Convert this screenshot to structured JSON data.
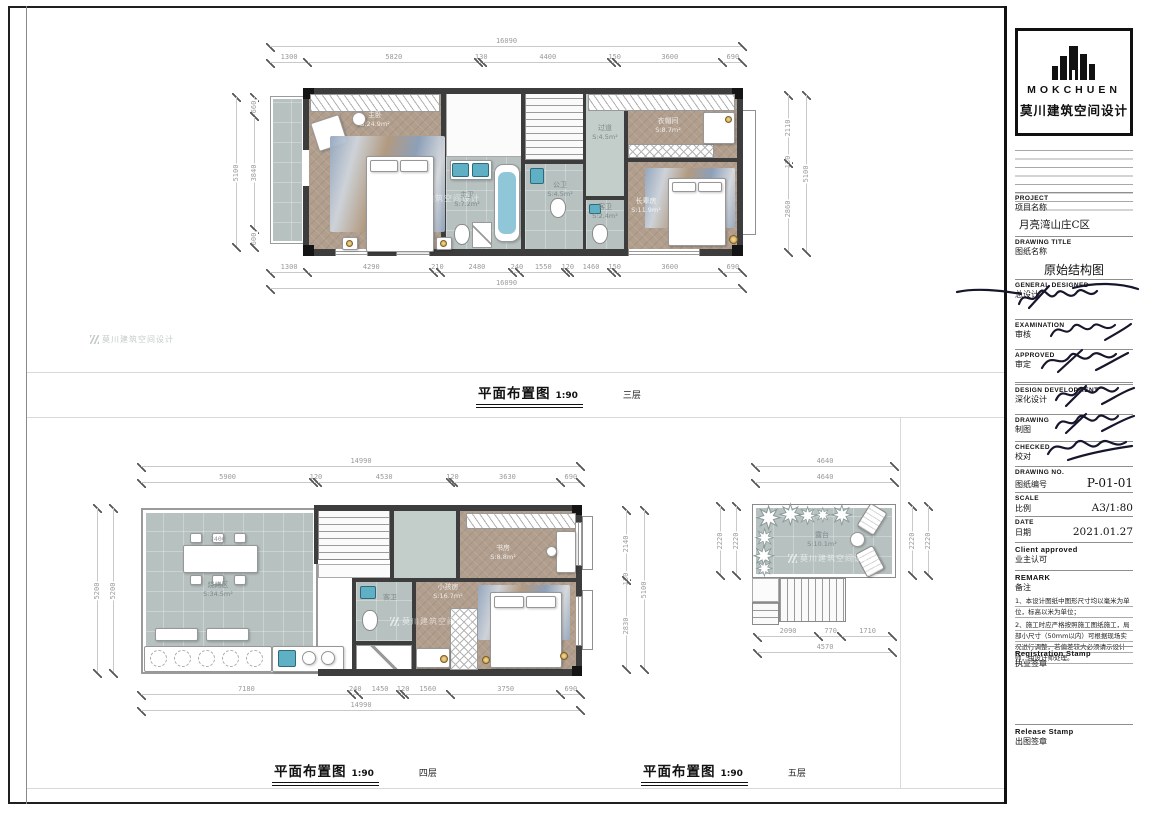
{
  "watermark": {
    "text": "莫川建筑空间设计"
  },
  "plans": {
    "p3": {
      "title": "平面布置图",
      "scale": "1:90",
      "floor": "三层",
      "rooms": [
        {
          "name": "主卧",
          "area": "S:24.9m²"
        },
        {
          "name": "主卫",
          "area": "S:7.2m²"
        },
        {
          "name": "公卫",
          "area": "S:4.5m²"
        },
        {
          "name": "过道",
          "area": "S:4.5m²"
        },
        {
          "name": "客卫",
          "area": "S:2.4m²"
        },
        {
          "name": "衣帽间",
          "area": "S:8.7m²"
        },
        {
          "name": "长辈房",
          "area": "S:11.9m²"
        }
      ],
      "dims": {
        "top_total": [
          "16090"
        ],
        "top": [
          "1300",
          "5820",
          "130",
          "4400",
          "150",
          "3600",
          "690"
        ],
        "bottom": [
          "1300",
          "4290",
          "210",
          "2480",
          "240",
          "1550",
          "120",
          "1460",
          "150",
          "3600",
          "690"
        ],
        "bottom_total": [
          "16090"
        ],
        "left_total": [
          "5100"
        ],
        "left": [
          "660",
          "3840",
          "600"
        ],
        "right": [
          "2110",
          "130",
          "2860"
        ],
        "right_total": [
          "5100"
        ]
      }
    },
    "p4": {
      "title": "平面布置图",
      "scale": "1:90",
      "floor": "四层",
      "rooms": [
        {
          "name": "烧烤区",
          "area": "S:34.5m²"
        },
        {
          "name": "书房",
          "area": "S:8.8m²"
        },
        {
          "name": "小孩房",
          "area": "S:16.7m²"
        },
        {
          "name": "客卫",
          "area": ""
        }
      ],
      "table_dim": "2400",
      "dims": {
        "top_total": [
          "14990"
        ],
        "top": [
          "5900",
          "120",
          "4530",
          "120",
          "3630",
          "690"
        ],
        "bottom": [
          "7180",
          "240",
          "1450",
          "120",
          "1560",
          "3750",
          "690"
        ],
        "bottom_total": [
          "14990"
        ],
        "left": [
          "5200"
        ],
        "left_total": [
          "5200"
        ],
        "right": [
          "2140",
          "130",
          "2830"
        ],
        "right_total": [
          "5100"
        ]
      }
    },
    "p5": {
      "title": "平面布置图",
      "scale": "1:90",
      "floor": "五层",
      "rooms": [
        {
          "name": "露台",
          "area": "S:10.1m²"
        }
      ],
      "dims": {
        "top_total": [
          "4640"
        ],
        "top": [
          "4640"
        ],
        "left_total": [
          "2220"
        ],
        "left": [
          "2220"
        ],
        "right": [
          "2220"
        ],
        "right_total": [
          "2220"
        ],
        "bottom": [
          "2090",
          "770",
          "1710"
        ],
        "bottom_total": [
          "4570"
        ]
      }
    }
  },
  "titleblock": {
    "brand": "MOKCHUEN",
    "brand_cn": "莫川建筑空间设计",
    "project": {
      "en": "PROJECT",
      "cn": "项目名称",
      "value": "月亮湾山庄C区"
    },
    "drawing_title": {
      "en": "DRAWING TITLE",
      "cn": "图纸名称",
      "value": "原始结构图"
    },
    "general_designed": {
      "en": "GENERAL  DESIGNED",
      "cn": "总设计"
    },
    "examination": {
      "en": "EXAMINATION",
      "cn": "审核"
    },
    "approved": {
      "en": "APPROVED",
      "cn": "审定"
    },
    "design_development": {
      "en": "DESIGN DEVELOPMENT",
      "cn": "深化设计"
    },
    "drawing": {
      "en": "DRAWING",
      "cn": "制图"
    },
    "checked": {
      "en": "CHECKED",
      "cn": "校对"
    },
    "drawing_no": {
      "en": "DRAWING NO.",
      "cn": "图纸编号",
      "value": "P-01-01"
    },
    "scale": {
      "en": "SCALE",
      "cn": "比例",
      "value": "A3/1:80"
    },
    "date": {
      "en": "DATE",
      "cn": "日期",
      "value": "2021.01.27"
    },
    "client_approved": {
      "en": "Client approved",
      "cn": "业主认可"
    },
    "remark": {
      "en": "REMARK",
      "cn": "备注",
      "note1": "1、本设计图纸中图形尺寸均以毫米为单位，标高以米为单位；",
      "note2": "2、施工时应严格按照施工图纸施工，局部小尺寸（50mm以内）可根据现场实况进行调整，若偏差较大必须请示设计师，由设计师处理。"
    },
    "registration_stamp": {
      "en": "Registration Stamp",
      "cn": "执业签章"
    },
    "release_stamp": {
      "en": "Release Stamp",
      "cn": "出图签章"
    }
  }
}
